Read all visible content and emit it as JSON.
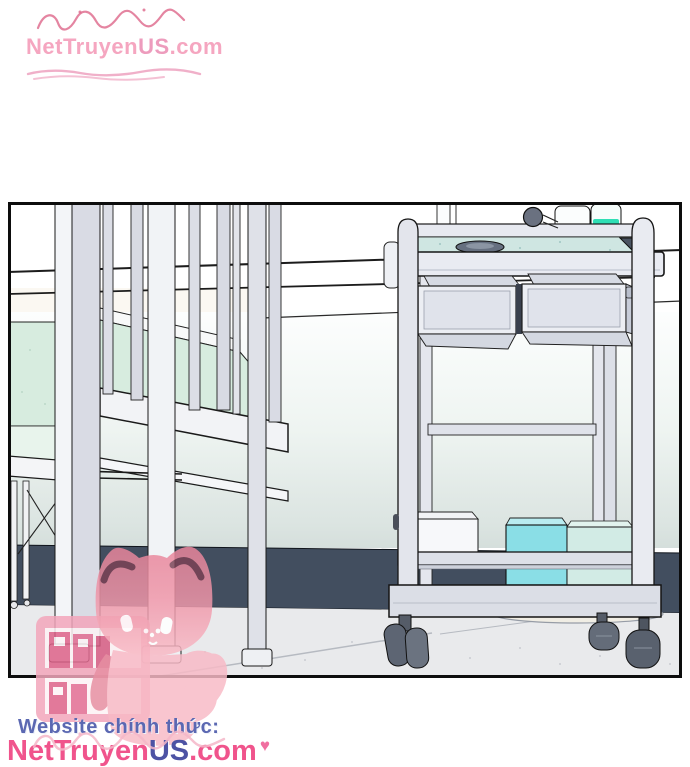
{
  "branding": {
    "top_watermark": {
      "net": "Net",
      "truyen": "Truyen",
      "us": "US",
      "dotcom": ".com"
    },
    "footer": {
      "label": "Website chính thức:",
      "logo": {
        "net": "Net",
        "truyen": "Truyen",
        "us": "US",
        "dotcom": ".com"
      },
      "heart": "♥"
    },
    "colors": {
      "logo_pink": "#f0548c",
      "logo_indigo": "#4d53a4",
      "label_blue": "#5b68b2",
      "watermark_pink": "#f49ab8",
      "flourish_red": "#d9537a"
    }
  },
  "panel": {
    "colors": {
      "outline": "#111111",
      "mint_mattress": "#d7ecdf",
      "teal_tray": "#cfe6e2",
      "bottle_green": "#2fdfb5",
      "cyan_box": "#8adee6",
      "navy_band": "#424e5f",
      "floor_gray": "#e9eaec",
      "frame_light": "#e9ebf1",
      "mascot_pink": "#f2a2b8"
    }
  }
}
